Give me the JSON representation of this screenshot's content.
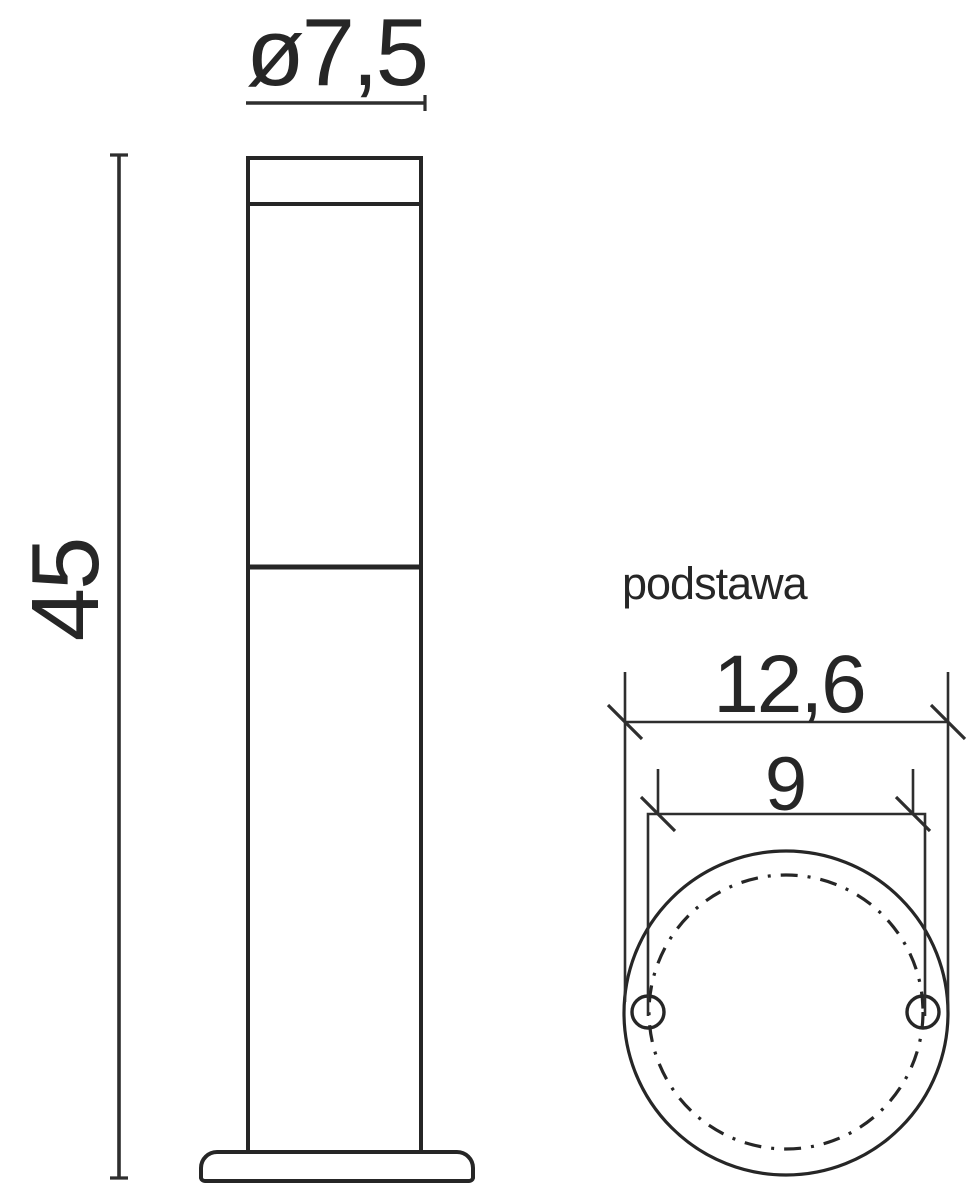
{
  "colors": {
    "line": "#262626",
    "dim_line": "#2e2e2e",
    "background": "#ffffff"
  },
  "front_view": {
    "diameter_dim_label": "ø7,5",
    "height_dim_label": "45"
  },
  "base_view": {
    "caption": "podstawa",
    "plate_diameter_dim_label": "12,6",
    "hole_spacing_dim_label": "9"
  }
}
